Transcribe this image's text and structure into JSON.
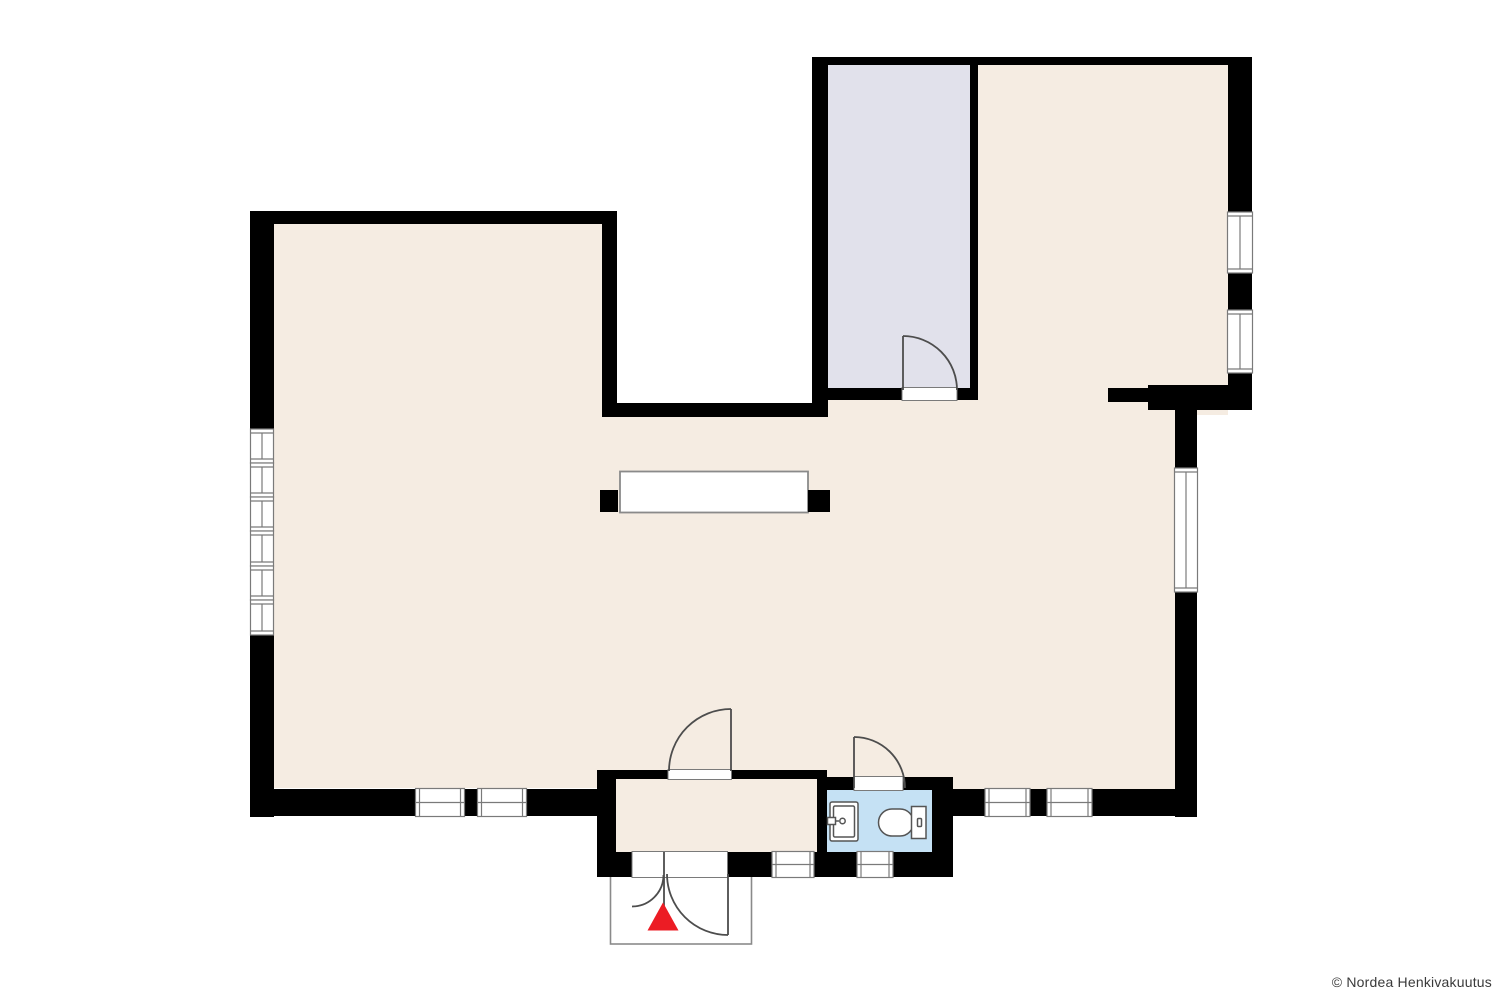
{
  "footer": {
    "copyright": "© Nordea Henkivakuutus"
  },
  "colors": {
    "background": "#ffffff",
    "wall": "#000000",
    "floor_main": "#f5ece2",
    "floor_secondary_room": "#e1e1eb",
    "floor_bathroom": "#c5e1f4",
    "window_fill": "#ffffff",
    "frame_stroke": "#7a7a7a",
    "door_stroke": "#4d4d4d",
    "porch_stroke": "#8a8a8a",
    "fixture_stroke": "#555555",
    "entrance_arrow": "#ec1c24",
    "text": "#3a3a3a"
  }
}
